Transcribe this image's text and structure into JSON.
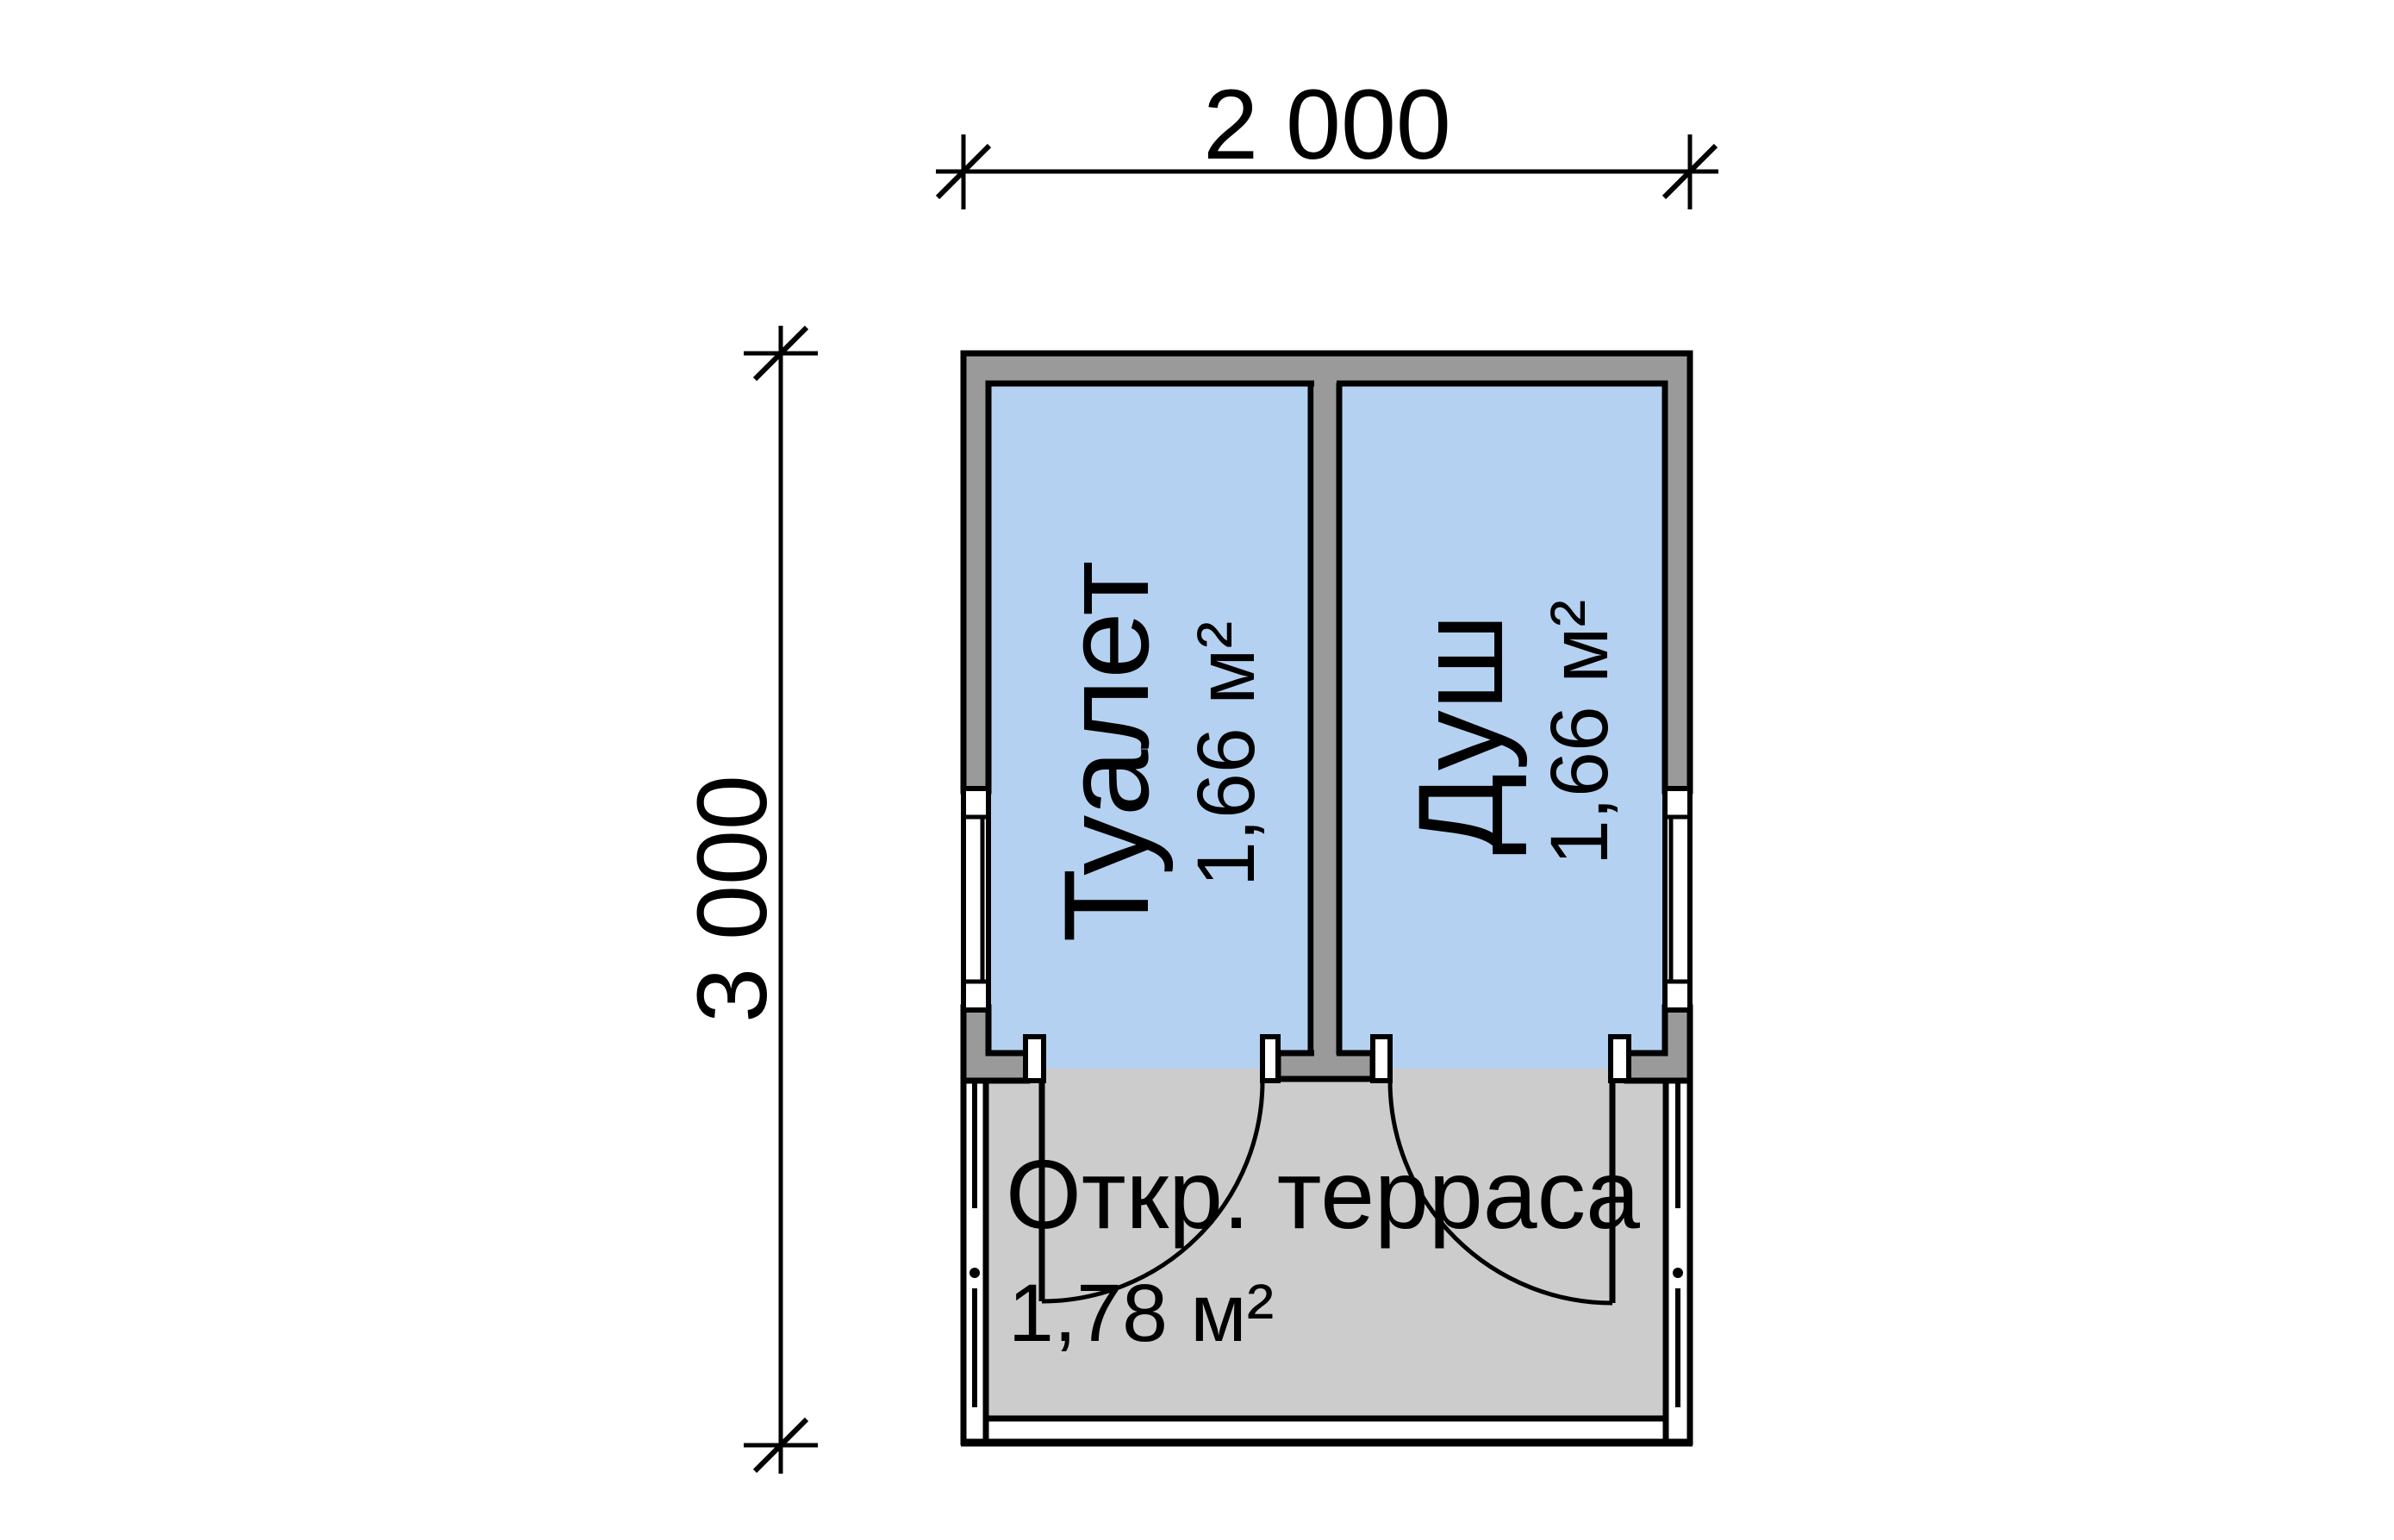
{
  "page": {
    "background": "#ffffff"
  },
  "plan": {
    "type": "floor-plan",
    "rooms": [
      {
        "name": "Туалет",
        "area": "1,66 м²"
      },
      {
        "name": "Душ",
        "area": "1,66 м²"
      },
      {
        "name": "Откр. терраса",
        "area": "1,78 м²"
      }
    ],
    "dimensions": {
      "width_mm": "2 000",
      "height_mm": "3 000"
    },
    "colors": {
      "wall": "#9a9a9a",
      "room_fill": "#b5d1f1",
      "terrace_fill": "#cccccc",
      "window_fill": "#ffffff",
      "line": "#000000"
    }
  }
}
